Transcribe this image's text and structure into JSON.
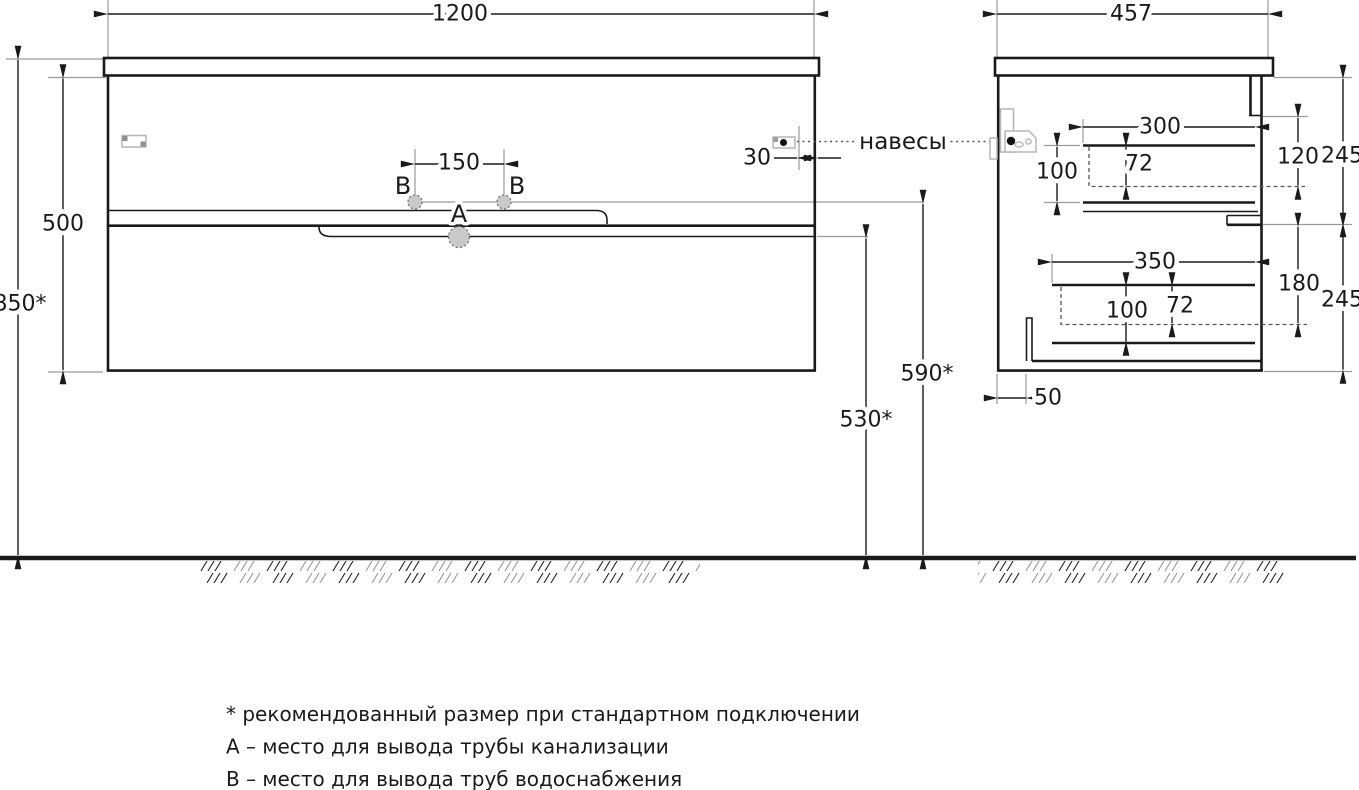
{
  "drawing": {
    "front": {
      "width": "1200",
      "total_height": "850*",
      "cabinet_height": "500",
      "hole_spacing": "150",
      "hanger_offset": "30",
      "hole_a": "A",
      "hole_b": "B",
      "supply_outlet_height": "590*",
      "drain_outlet_height": "530*"
    },
    "side": {
      "depth": "457",
      "top_drawer": {
        "width": "300",
        "zone_height": "120",
        "section_height": "245",
        "front_height": "100",
        "inner_depth": "72"
      },
      "bottom_drawer": {
        "width": "350",
        "zone_height": "180",
        "section_height": "245",
        "front_height": "100",
        "inner_depth": "72"
      },
      "siphon_gap": "50"
    },
    "hangers_label": "навесы"
  },
  "notes": {
    "recommended": "* рекомендованный размер при стандартном подключении",
    "hole_a": "A – место для вывода трубы канализации",
    "hole_b": "B – место для вывода труб водоснабжения"
  },
  "colors": {
    "line": "#1a1a1a",
    "ext_line": "#9a9a9a",
    "hole_fill": "#c9c9c9",
    "hardware": "#b5b5b5"
  }
}
